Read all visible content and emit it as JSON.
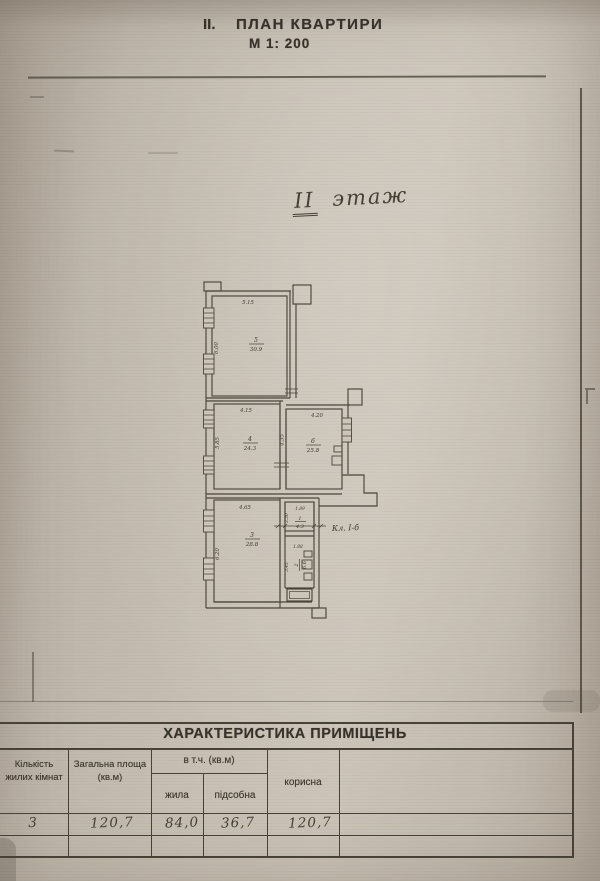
{
  "page": {
    "title_prefix": "II.",
    "title": "ПЛАН КВАРТИРИ",
    "scale": "М 1: 200",
    "floor_numeral": "ІІ",
    "floor_word": "этаж"
  },
  "plan": {
    "annotation": "Кл. І-б",
    "rooms": {
      "r5": {
        "num": "5",
        "area": "30.9"
      },
      "r4": {
        "num": "4",
        "area": "24.3"
      },
      "r6": {
        "num": "6",
        "area": "25.8"
      },
      "r3": {
        "num": "3",
        "area": "28.8"
      },
      "r1": {
        "num": "1",
        "area": "4.3"
      },
      "r2": {
        "num": "2",
        "area": "6.6"
      }
    },
    "dims": {
      "r5w": "5.15",
      "r5h": "6.00",
      "r4w": "4.15",
      "r4h": "5.85",
      "r46": "4.35",
      "r6w": "4.20",
      "r3w": "4.65",
      "r3h": "6.20",
      "r1w": "1.89",
      "r1h": "2.30",
      "r2w": "1.88",
      "r2h": "3.45"
    }
  },
  "table": {
    "title": "ХАРАКТЕРИСТИКА  ПРИМІЩЕНЬ",
    "headers": {
      "count": "Кількість жилих кімнат",
      "total": "Загальна площа (кв.м)",
      "incl": "в т.ч.  (кв.м)",
      "living": "жила",
      "aux": "підсобна",
      "useful": "корисна"
    },
    "row": {
      "count": "3",
      "total": "120,7",
      "living": "84,0",
      "aux": "36,7",
      "useful": "120,7"
    }
  }
}
